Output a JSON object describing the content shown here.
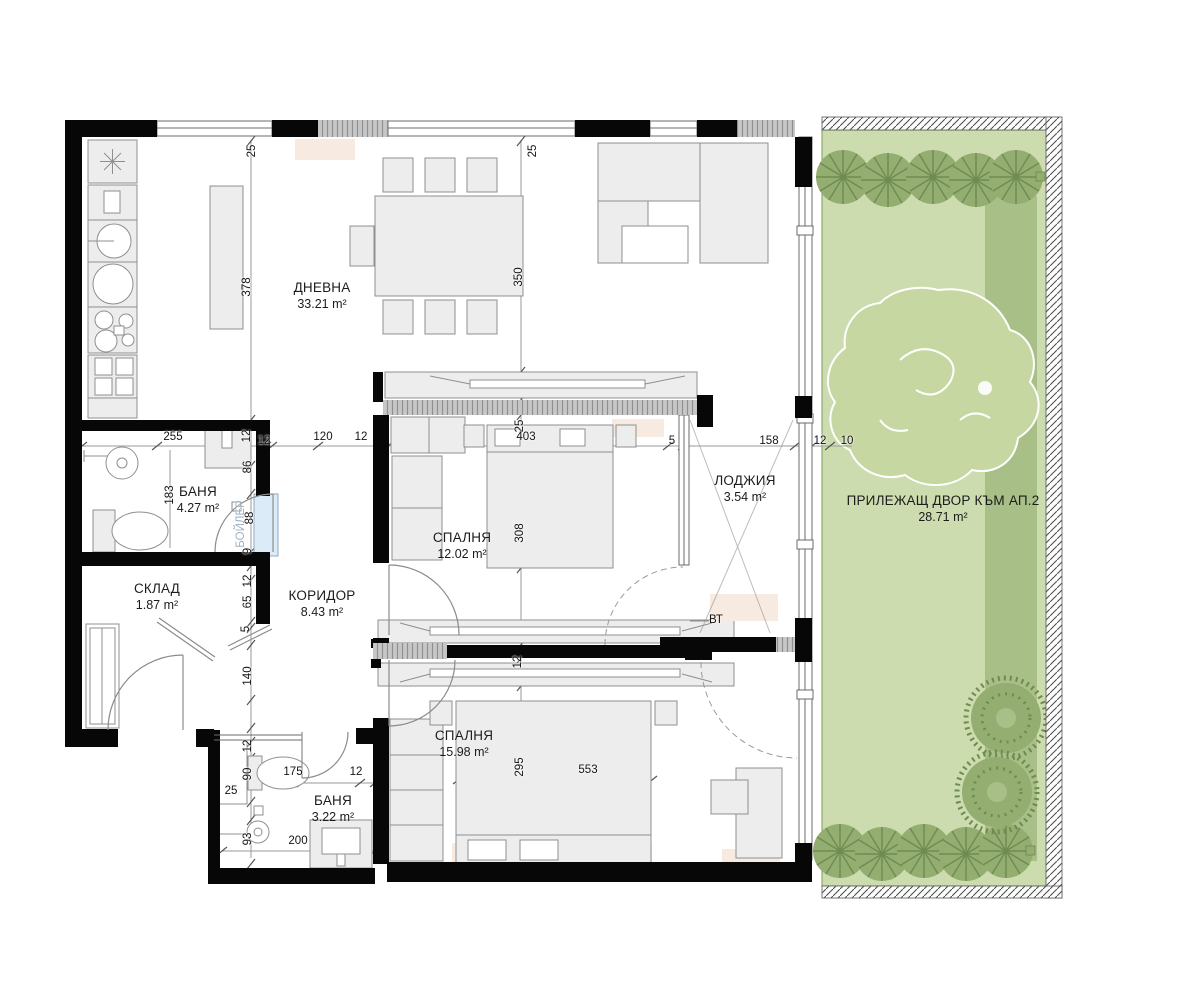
{
  "rooms": [
    {
      "id": "dnevna",
      "name": "ДНЕВНА",
      "area": "33.21 m²",
      "x": 322,
      "y": 296
    },
    {
      "id": "banya-1",
      "name": "БАНЯ",
      "area": "4.27 m²",
      "x": 198,
      "y": 500
    },
    {
      "id": "sklad",
      "name": "СКЛАД",
      "area": "1.87 m²",
      "x": 157,
      "y": 597
    },
    {
      "id": "koridor",
      "name": "КОРИДОР",
      "area": "8.43 m²",
      "x": 322,
      "y": 604
    },
    {
      "id": "spalnya-1",
      "name": "СПАЛНЯ",
      "area": "12.02 m²",
      "x": 462,
      "y": 546
    },
    {
      "id": "lodzhiya",
      "name": "ЛОДЖИЯ",
      "area": "3.54 m²",
      "x": 745,
      "y": 489
    },
    {
      "id": "spalnya-2",
      "name": "СПАЛНЯ",
      "area": "15.98 m²",
      "x": 464,
      "y": 744
    },
    {
      "id": "banya-2",
      "name": "БАНЯ",
      "area": "3.22 m²",
      "x": 333,
      "y": 809
    },
    {
      "id": "dvor",
      "name": "ПРИЛЕЖАЩ ДВОР КЪМ АП.2",
      "area": "28.71 m²",
      "x": 943,
      "y": 509
    }
  ],
  "dimensions": [
    {
      "t": "25",
      "x": 252,
      "y": 151,
      "o": "v"
    },
    {
      "t": "25",
      "x": 533,
      "y": 151,
      "o": "v"
    },
    {
      "t": "378",
      "x": 247,
      "y": 287,
      "o": "v"
    },
    {
      "t": "350",
      "x": 519,
      "y": 277,
      "o": "v"
    },
    {
      "t": "255",
      "x": 173,
      "y": 437,
      "o": "h"
    },
    {
      "t": "12",
      "x": 247,
      "y": 436,
      "o": "v"
    },
    {
      "t": "12",
      "x": 264,
      "y": 441,
      "o": "h"
    },
    {
      "t": "120",
      "x": 323,
      "y": 437,
      "o": "h"
    },
    {
      "t": "12",
      "x": 361,
      "y": 437,
      "o": "h"
    },
    {
      "t": "86",
      "x": 248,
      "y": 467,
      "o": "v"
    },
    {
      "t": "25",
      "x": 520,
      "y": 426,
      "o": "v"
    },
    {
      "t": "403",
      "x": 526,
      "y": 437,
      "o": "h"
    },
    {
      "t": "5",
      "x": 672,
      "y": 441,
      "o": "h"
    },
    {
      "t": "158",
      "x": 769,
      "y": 441,
      "o": "h"
    },
    {
      "t": "12",
      "x": 820,
      "y": 441,
      "o": "h"
    },
    {
      "t": "10",
      "x": 847,
      "y": 441,
      "o": "h"
    },
    {
      "t": "183",
      "x": 170,
      "y": 495,
      "o": "v"
    },
    {
      "t": "88",
      "x": 250,
      "y": 518,
      "o": "v"
    },
    {
      "t": "9",
      "x": 248,
      "y": 551,
      "o": "v"
    },
    {
      "t": "308",
      "x": 520,
      "y": 533,
      "o": "v"
    },
    {
      "t": "12",
      "x": 248,
      "y": 581,
      "o": "v"
    },
    {
      "t": "65",
      "x": 248,
      "y": 602,
      "o": "v"
    },
    {
      "t": "5",
      "x": 246,
      "y": 629,
      "o": "v"
    },
    {
      "t": "140",
      "x": 248,
      "y": 676,
      "o": "v"
    },
    {
      "t": "12",
      "x": 518,
      "y": 662,
      "o": "v"
    },
    {
      "t": "295",
      "x": 520,
      "y": 767,
      "o": "v"
    },
    {
      "t": "553",
      "x": 588,
      "y": 770,
      "o": "h"
    },
    {
      "t": "12",
      "x": 248,
      "y": 746,
      "o": "v"
    },
    {
      "t": "90",
      "x": 248,
      "y": 774,
      "o": "v"
    },
    {
      "t": "25",
      "x": 231,
      "y": 791,
      "o": "h"
    },
    {
      "t": "175",
      "x": 293,
      "y": 772,
      "o": "h"
    },
    {
      "t": "12",
      "x": 356,
      "y": 772,
      "o": "h"
    },
    {
      "t": "93",
      "x": 248,
      "y": 839,
      "o": "v"
    },
    {
      "t": "200",
      "x": 298,
      "y": 841,
      "o": "h"
    }
  ],
  "notes": [
    {
      "id": "boiler-label",
      "text": "БОЙЛЕР",
      "x": 241,
      "y": 524,
      "o": "v",
      "color": "#9fb3c6"
    },
    {
      "id": "vt-label",
      "text": "ВТ",
      "x": 716,
      "y": 620,
      "o": "h",
      "color": "#111111"
    }
  ],
  "colors": {
    "text": "#1c1c1c",
    "wall": "#070707",
    "furn": "#ededed",
    "furn_line": "#8f8f8f",
    "dim_line": "#9a9a9a",
    "garden": "#ccdcae",
    "garden_dark": "#a8bf88",
    "hedge": "#93ae70",
    "hedge_line": "#6f8b52",
    "tree_blob": "#c6d7a1",
    "rug": "#f7ebe1",
    "boiler": "#dcebf8"
  }
}
